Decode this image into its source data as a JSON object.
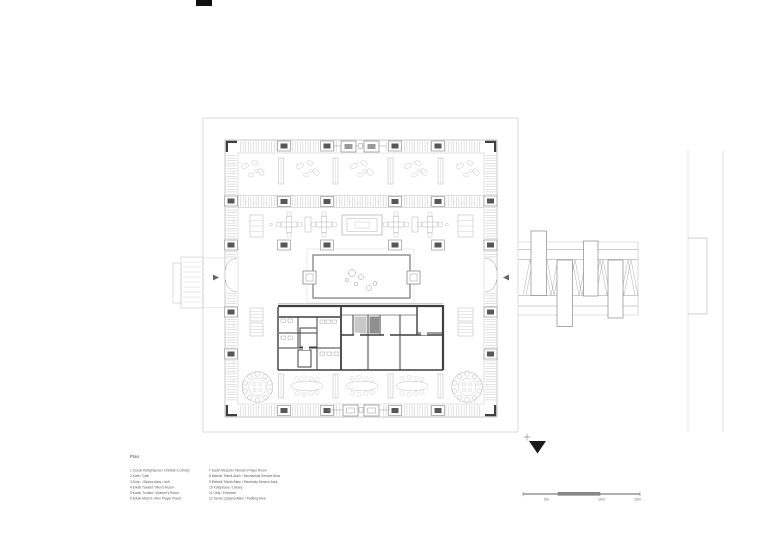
{
  "drawing": {
    "title": "Plan"
  },
  "legend": {
    "left": [
      "1 Çocuk Kütüphanesi / Children's Library",
      "2 Kafe / Cafe",
      "3 Sofa - Okuma Alanı / Anfi",
      "4 Erkek Tuvalet / Men's Room",
      "5 Kadın Tuvalet / Women's Room",
      "6 Erkek Mescit / Men Prayer Room"
    ],
    "right": [
      "7 Kadın Mescidi / Women Prayer Room",
      "8 Makine Teknik Alanı / Mechanical Service Area",
      "9 Elektrik Teknik Alanı / Electricity Service Area",
      "10 Kütüphane / Library",
      "11 Giriş / Entrance",
      "12 Servis Çalışma Alanı / Parking Area"
    ]
  },
  "scale_bar": {
    "labels": [
      "5m",
      "10m",
      "15m"
    ]
  },
  "icons": {
    "north_arrow": "filled-triangle-down",
    "north_marker": "+"
  },
  "colors": {
    "background": "#ffffff",
    "line_light": "#c4c4c4",
    "line_mid": "#969696",
    "wall_dark": "#3f3f3f",
    "column_fill": "#575757",
    "north_arrow_fill": "#1a1a1a",
    "text": "#5a5a5a"
  }
}
